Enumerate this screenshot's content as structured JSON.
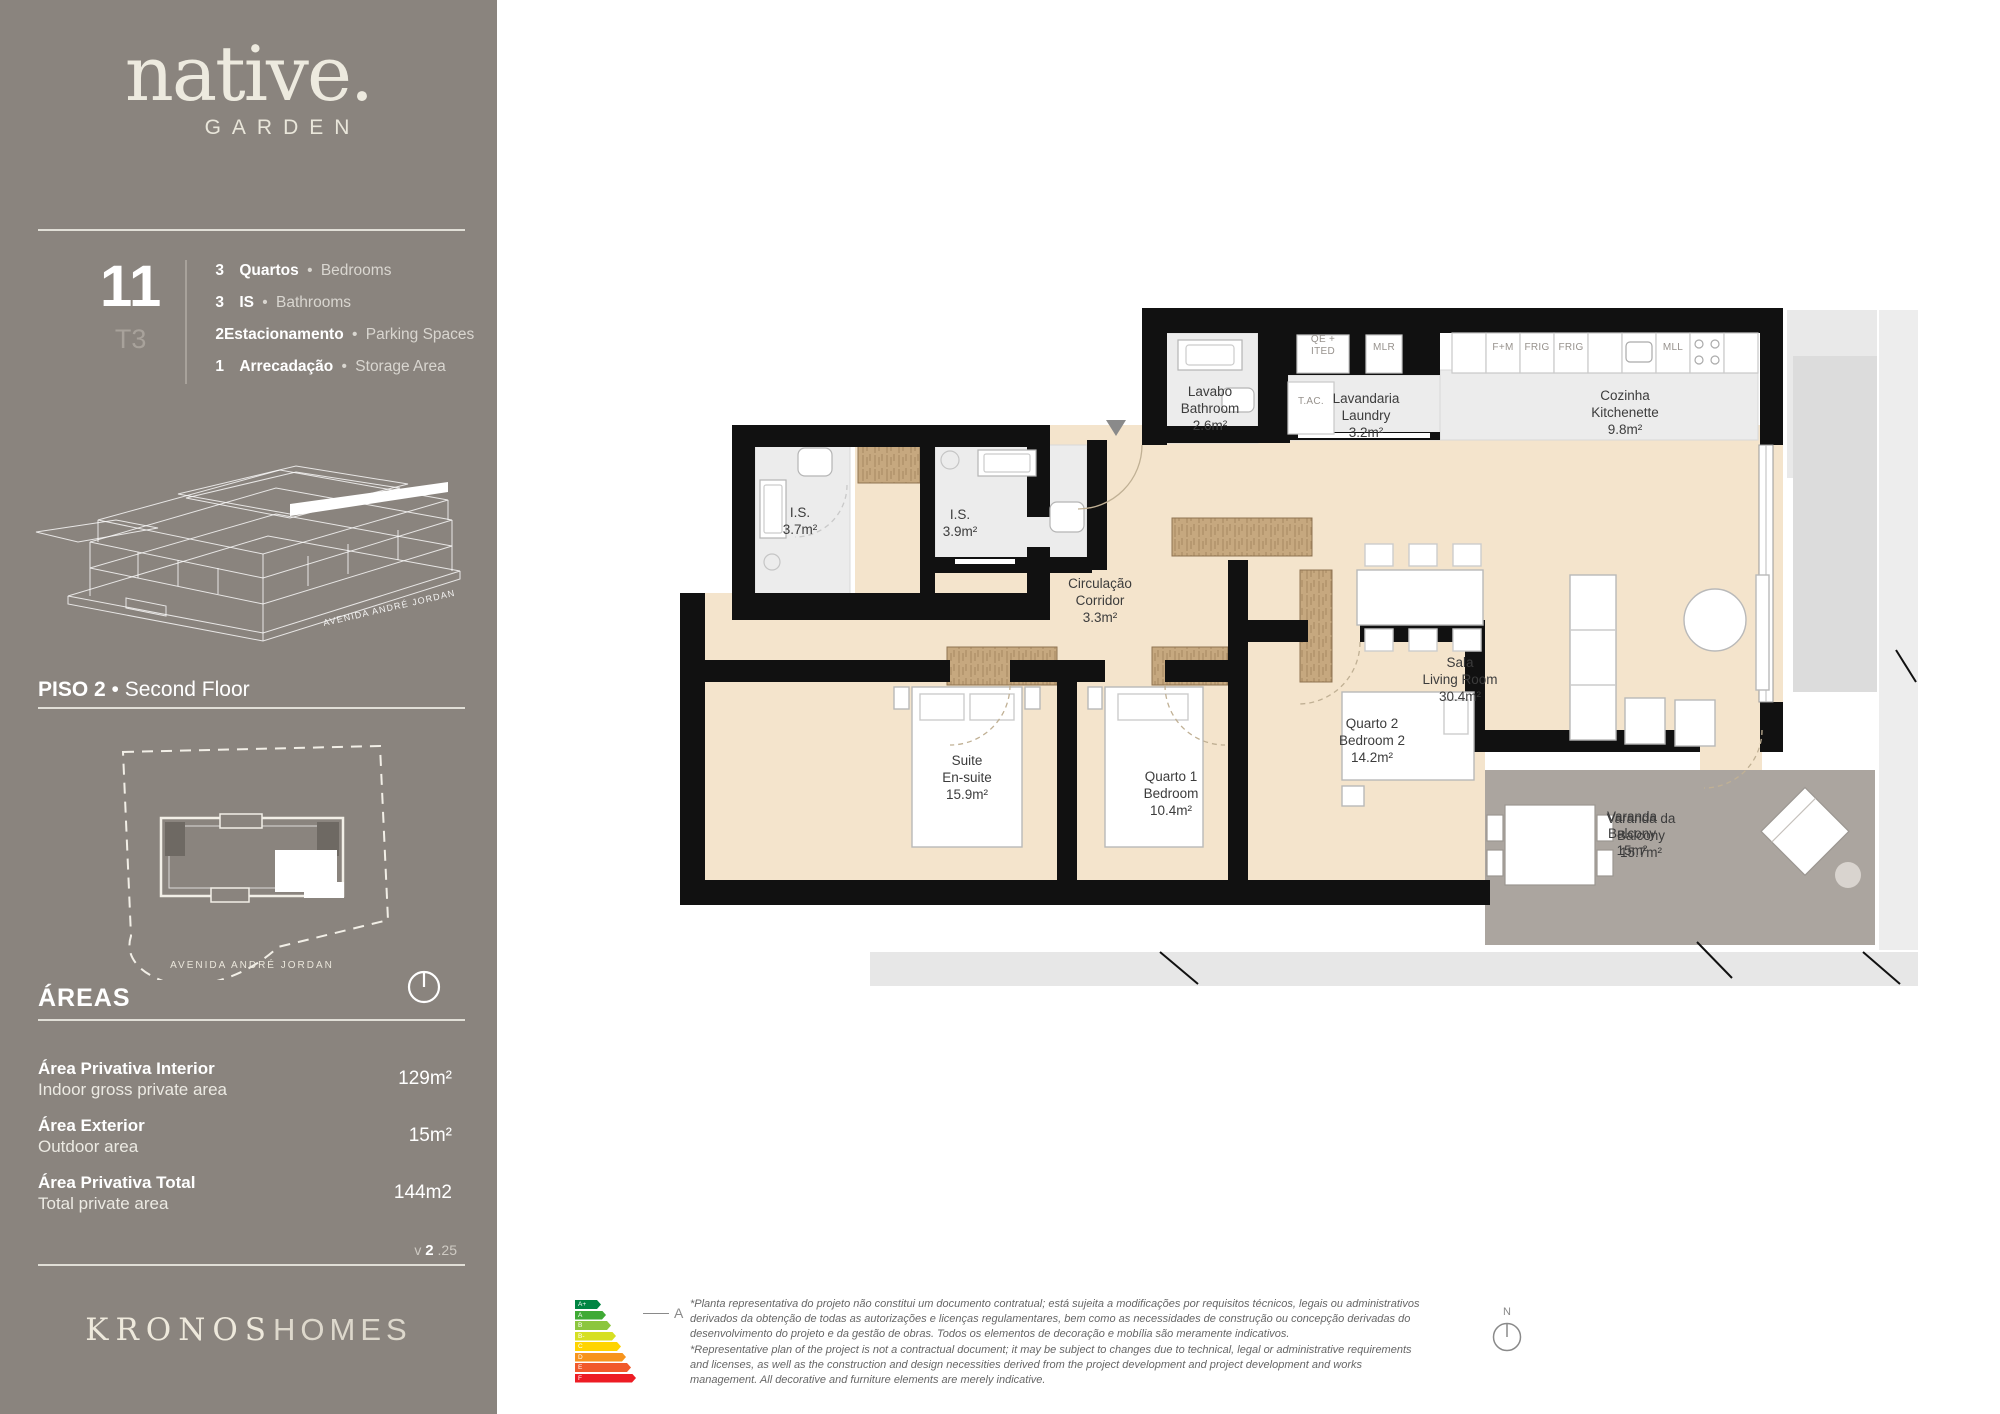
{
  "sep": "•",
  "colors": {
    "sidebar_bg": "#8a847e",
    "cream": "#edeadf",
    "floor_beige": "#f4e4cc",
    "marble": "#ececec",
    "wood": "#c6a87f",
    "wall": "#111111",
    "balcony_gray": "#aba59f",
    "walk_gray": "#e7e7e7"
  },
  "sidebar": {
    "brand": {
      "name": "native.",
      "sub": "GARDEN"
    },
    "unit": {
      "number": "11",
      "type": "T3"
    },
    "specs": [
      {
        "num": "3",
        "pt": "Quartos",
        "en": "Bedrooms",
        "tight": false
      },
      {
        "num": "3",
        "pt": "IS",
        "en": "Bathrooms",
        "tight": false
      },
      {
        "num": "2",
        "pt": "Estacionamento",
        "en": "Parking Spaces",
        "tight": true
      },
      {
        "num": "1",
        "pt": "Arrecadação",
        "en": "Storage Area",
        "tight": false
      }
    ],
    "building_caption": "AVENIDA ANDRÉ JORDAN",
    "floor": {
      "pt": "PISO 2",
      "en": "Second Floor"
    },
    "siteplan_caption": "AVENIDA ANDRÉ JORDAN",
    "areas": {
      "title": "ÁREAS",
      "rows": [
        {
          "pt": "Área Privativa Interior",
          "en": "Indoor gross private area",
          "value": "129m²"
        },
        {
          "pt": "Área Exterior",
          "en": "Outdoor area",
          "value": "15m²"
        },
        {
          "pt": "Área Privativa Total",
          "en": "Total private area",
          "value": "144m2"
        }
      ]
    },
    "version": {
      "prefix": "v",
      "number": "2",
      "suffix": ".25"
    },
    "footer_brand": {
      "serif": "KRONOS",
      "sans": "HOMES"
    }
  },
  "plan": {
    "rooms": [
      {
        "id": "lavabo",
        "lines": [
          "Lavabo",
          "Bathroom",
          "2.6m²"
        ],
        "x": 650,
        "y": 153
      },
      {
        "id": "laundry",
        "lines": [
          "Lavandaria",
          "Laundry",
          "3.2m²"
        ],
        "x": 806,
        "y": 160
      },
      {
        "id": "kitchen",
        "lines": [
          "Cozinha",
          "Kitchenette",
          "9.8m²"
        ],
        "x": 1065,
        "y": 157
      },
      {
        "id": "is-3-7",
        "lines": [
          "I.S.",
          "3.7m²"
        ],
        "x": 240,
        "y": 274
      },
      {
        "id": "is-3-9",
        "lines": [
          "I.S.",
          "3.9m²"
        ],
        "x": 400,
        "y": 276
      },
      {
        "id": "corridor",
        "lines": [
          "Circulação",
          "Corridor",
          "3.3m²"
        ],
        "x": 540,
        "y": 345
      },
      {
        "id": "suite",
        "lines": [
          "Suite",
          "En-suite",
          "15.9m²"
        ],
        "x": 407,
        "y": 522
      },
      {
        "id": "bedroom-1",
        "lines": [
          "Quarto 1",
          "Bedroom",
          "10.4m²"
        ],
        "x": 611,
        "y": 538
      },
      {
        "id": "bedroom-2",
        "lines": [
          "Quarto 2",
          "Bedroom 2",
          "14.2m²"
        ],
        "x": 812,
        "y": 485
      },
      {
        "id": "living",
        "lines": [
          "Sala",
          "Living Room",
          "30.4m²"
        ],
        "x": 900,
        "y": 424
      },
      {
        "id": "balcony",
        "lines": [
          "Varanda",
          "Balcony",
          "15m²"
        ],
        "x": 1072,
        "y": 578
      },
      {
        "id": "balcony-2",
        "lines": [
          "Varanda da",
          "Balcony",
          "15.7m²"
        ],
        "x": 1081,
        "y": 580
      }
    ],
    "fixture_labels": [
      {
        "id": "qe-ited",
        "lines": [
          "QE +",
          "ITED"
        ],
        "x": 763,
        "y": 104
      },
      {
        "id": "mlr",
        "lines": [
          "MLR"
        ],
        "x": 824,
        "y": 112
      },
      {
        "id": "tac",
        "lines": [
          "T.AC."
        ],
        "x": 751,
        "y": 166
      },
      {
        "id": "f-m",
        "lines": [
          "F+M"
        ],
        "x": 943,
        "y": 112
      },
      {
        "id": "frig-1",
        "lines": [
          "FRIG"
        ],
        "x": 977,
        "y": 112
      },
      {
        "id": "frig-2",
        "lines": [
          "FRIG"
        ],
        "x": 1011,
        "y": 112
      },
      {
        "id": "mll",
        "lines": [
          "MLL"
        ],
        "x": 1113,
        "y": 112
      }
    ]
  },
  "energy": {
    "classes": [
      {
        "label": "A+",
        "color": "#008542",
        "width": 26
      },
      {
        "label": "A",
        "color": "#3faa35",
        "width": 31
      },
      {
        "label": "B",
        "color": "#8cc63e",
        "width": 36
      },
      {
        "label": "B-",
        "color": "#d6df23",
        "width": 41
      },
      {
        "label": "C",
        "color": "#ffd400",
        "width": 46
      },
      {
        "label": "D",
        "color": "#f7941d",
        "width": 51
      },
      {
        "label": "E",
        "color": "#f1592a",
        "width": 56
      },
      {
        "label": "F",
        "color": "#ed1c24",
        "width": 61
      }
    ],
    "rating": "A"
  },
  "disclaimer": {
    "pt": "*Planta representativa do projeto não constitui um documento contratual; está sujeita a modificações por requisitos técnicos, legais ou administrativos derivados da obtenção de todas as autorizações e licenças regulamentares, bem como as necessidades de construção ou concepção derivadas do desenvolvimento do projeto e da gestão de obras. Todos os elementos de decoração e mobília são meramente indicativos.",
    "en": "*Representative plan of the project is not a contractual document; it may be subject to changes due to technical, legal or administrative requirements and licenses, as well as the construction and design necessities derived from the project development and project development and works management. All decorative and furniture elements are merely indicative."
  },
  "north_label": "N"
}
